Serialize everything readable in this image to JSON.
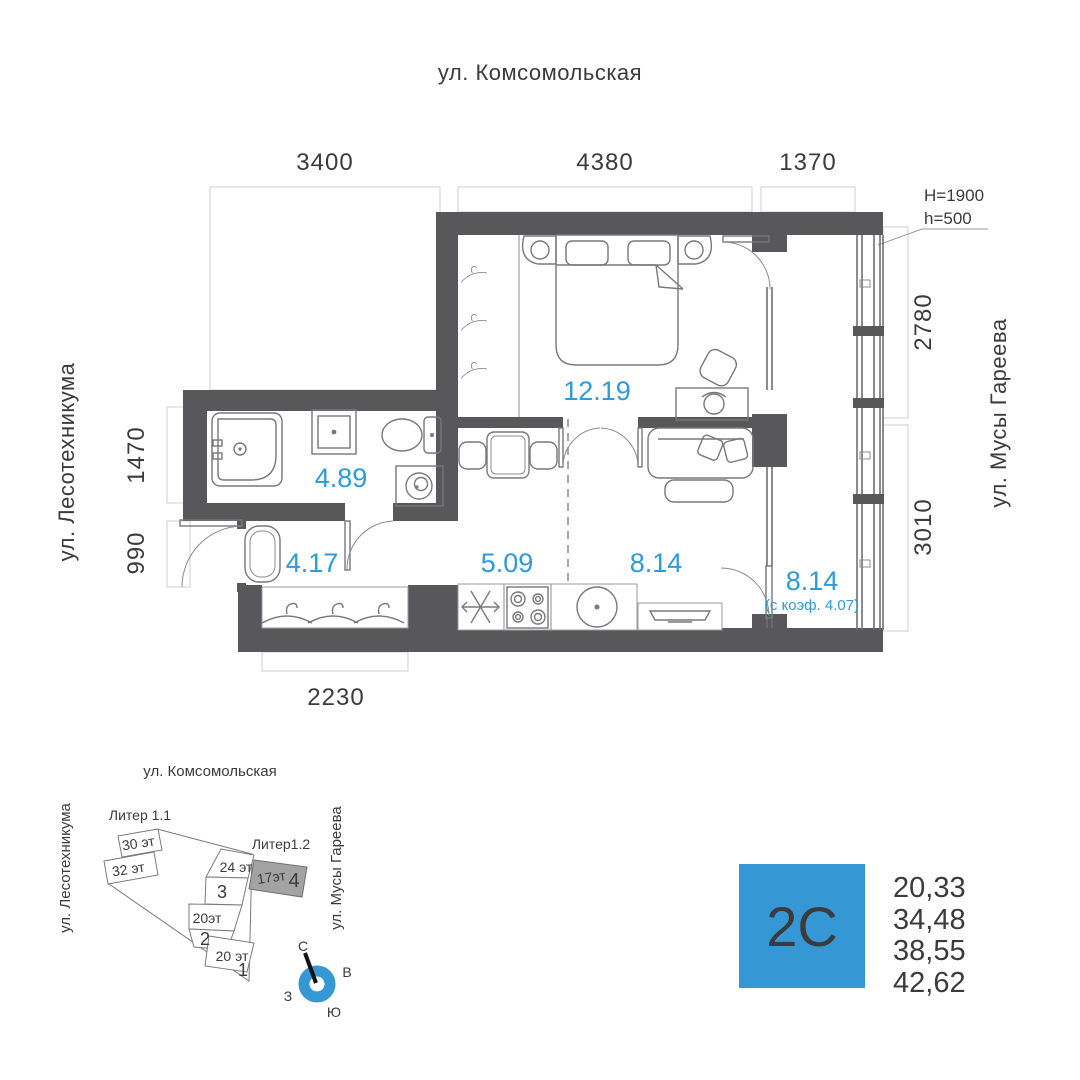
{
  "floor_plan": {
    "street_top": "ул. Комсомольская",
    "street_left": "ул. Лесотехникума",
    "street_right": "ул. Мусы Гареева",
    "dimensions": {
      "top_left": "3400",
      "top_center": "4380",
      "top_right": "1370",
      "right_upper": "2780",
      "right_lower": "3010",
      "left_upper": "1470",
      "left_lower": "990",
      "bottom": "2230"
    },
    "window_note": {
      "line1": "H=1900",
      "line2": "h=500"
    },
    "room_areas": {
      "bedroom": "12.19",
      "bathroom": "4.89",
      "hallway": "4.17",
      "kitchen": "5.09",
      "living": "8.14",
      "balcony": "8.14",
      "balcony_coef": "(с коэф. 4.07)"
    }
  },
  "site_plan": {
    "street_top": "ул. Комсомольская",
    "street_left": "ул. Лесотехникума",
    "street_right": "ул. Мусы Гареева",
    "liter_1_1": "Литер 1.1",
    "liter_1_2": "Литер1.2",
    "buildings": {
      "b30": "30 эт",
      "b32": "32 эт",
      "b24": "24 эт",
      "b24_num": "3",
      "b20a": "20эт",
      "b20a_num": "2",
      "b20b": "20 эт",
      "b20b_num": "1",
      "b17": "17эт",
      "b17_num": "4"
    },
    "compass": {
      "north": "С",
      "east": "В",
      "south": "Ю",
      "west": "З"
    }
  },
  "legend": {
    "plate": "2С",
    "values": [
      "20,33",
      "34,48",
      "38,55",
      "42,62"
    ]
  },
  "colors": {
    "accent_blue": "#3598d4",
    "area_label_blue": "#2e9bd6",
    "wall_gray": "#58585a",
    "building_highlight_gray": "#a3a3a3"
  }
}
